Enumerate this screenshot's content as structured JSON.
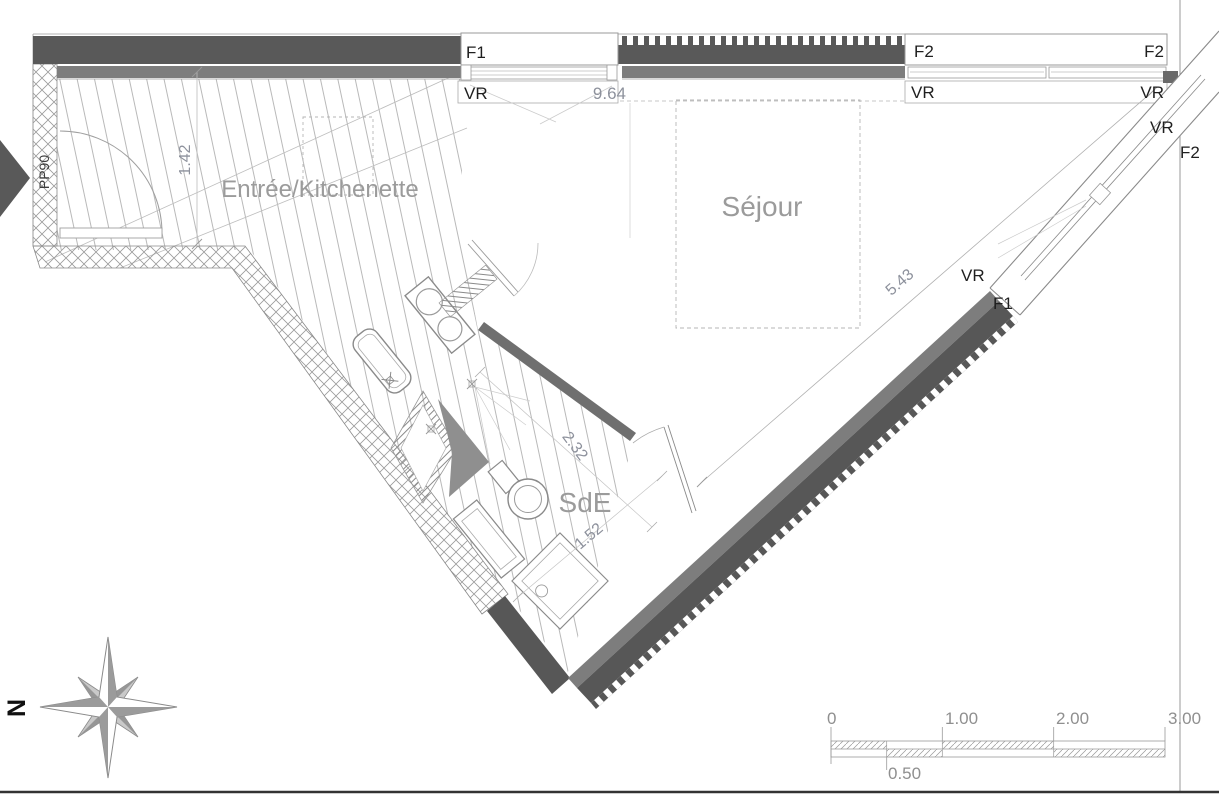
{
  "rooms": {
    "entree": "Entrée/Kitchenette",
    "sejour": "Séjour",
    "sde": "SdE"
  },
  "openings": {
    "f1": "F1",
    "f2": "F2",
    "vr": "VR",
    "pp90": "PP90"
  },
  "dimensions": {
    "entree_height": "1.42",
    "top_facade": "9.64",
    "diagonal_facade": "5.43",
    "sde_length": "2.32",
    "sde_width": "1.52"
  },
  "compass": {
    "north_label": "N"
  },
  "scale_bar": {
    "tick_0": "0",
    "tick_05": "0.50",
    "tick_1": "1.00",
    "tick_2": "2.00",
    "tick_3": "3.00"
  },
  "colors": {
    "wall_dark": "#595959",
    "wall_medium": "#7d7d7d",
    "partition": "#6f6f6f",
    "hatch_line": "#b9b9b9",
    "room_text": "#9b9b9b",
    "dimension_text": "#8d919c",
    "opening_text": "#1f1f1f",
    "compass_gray": "#9b9b9b"
  }
}
